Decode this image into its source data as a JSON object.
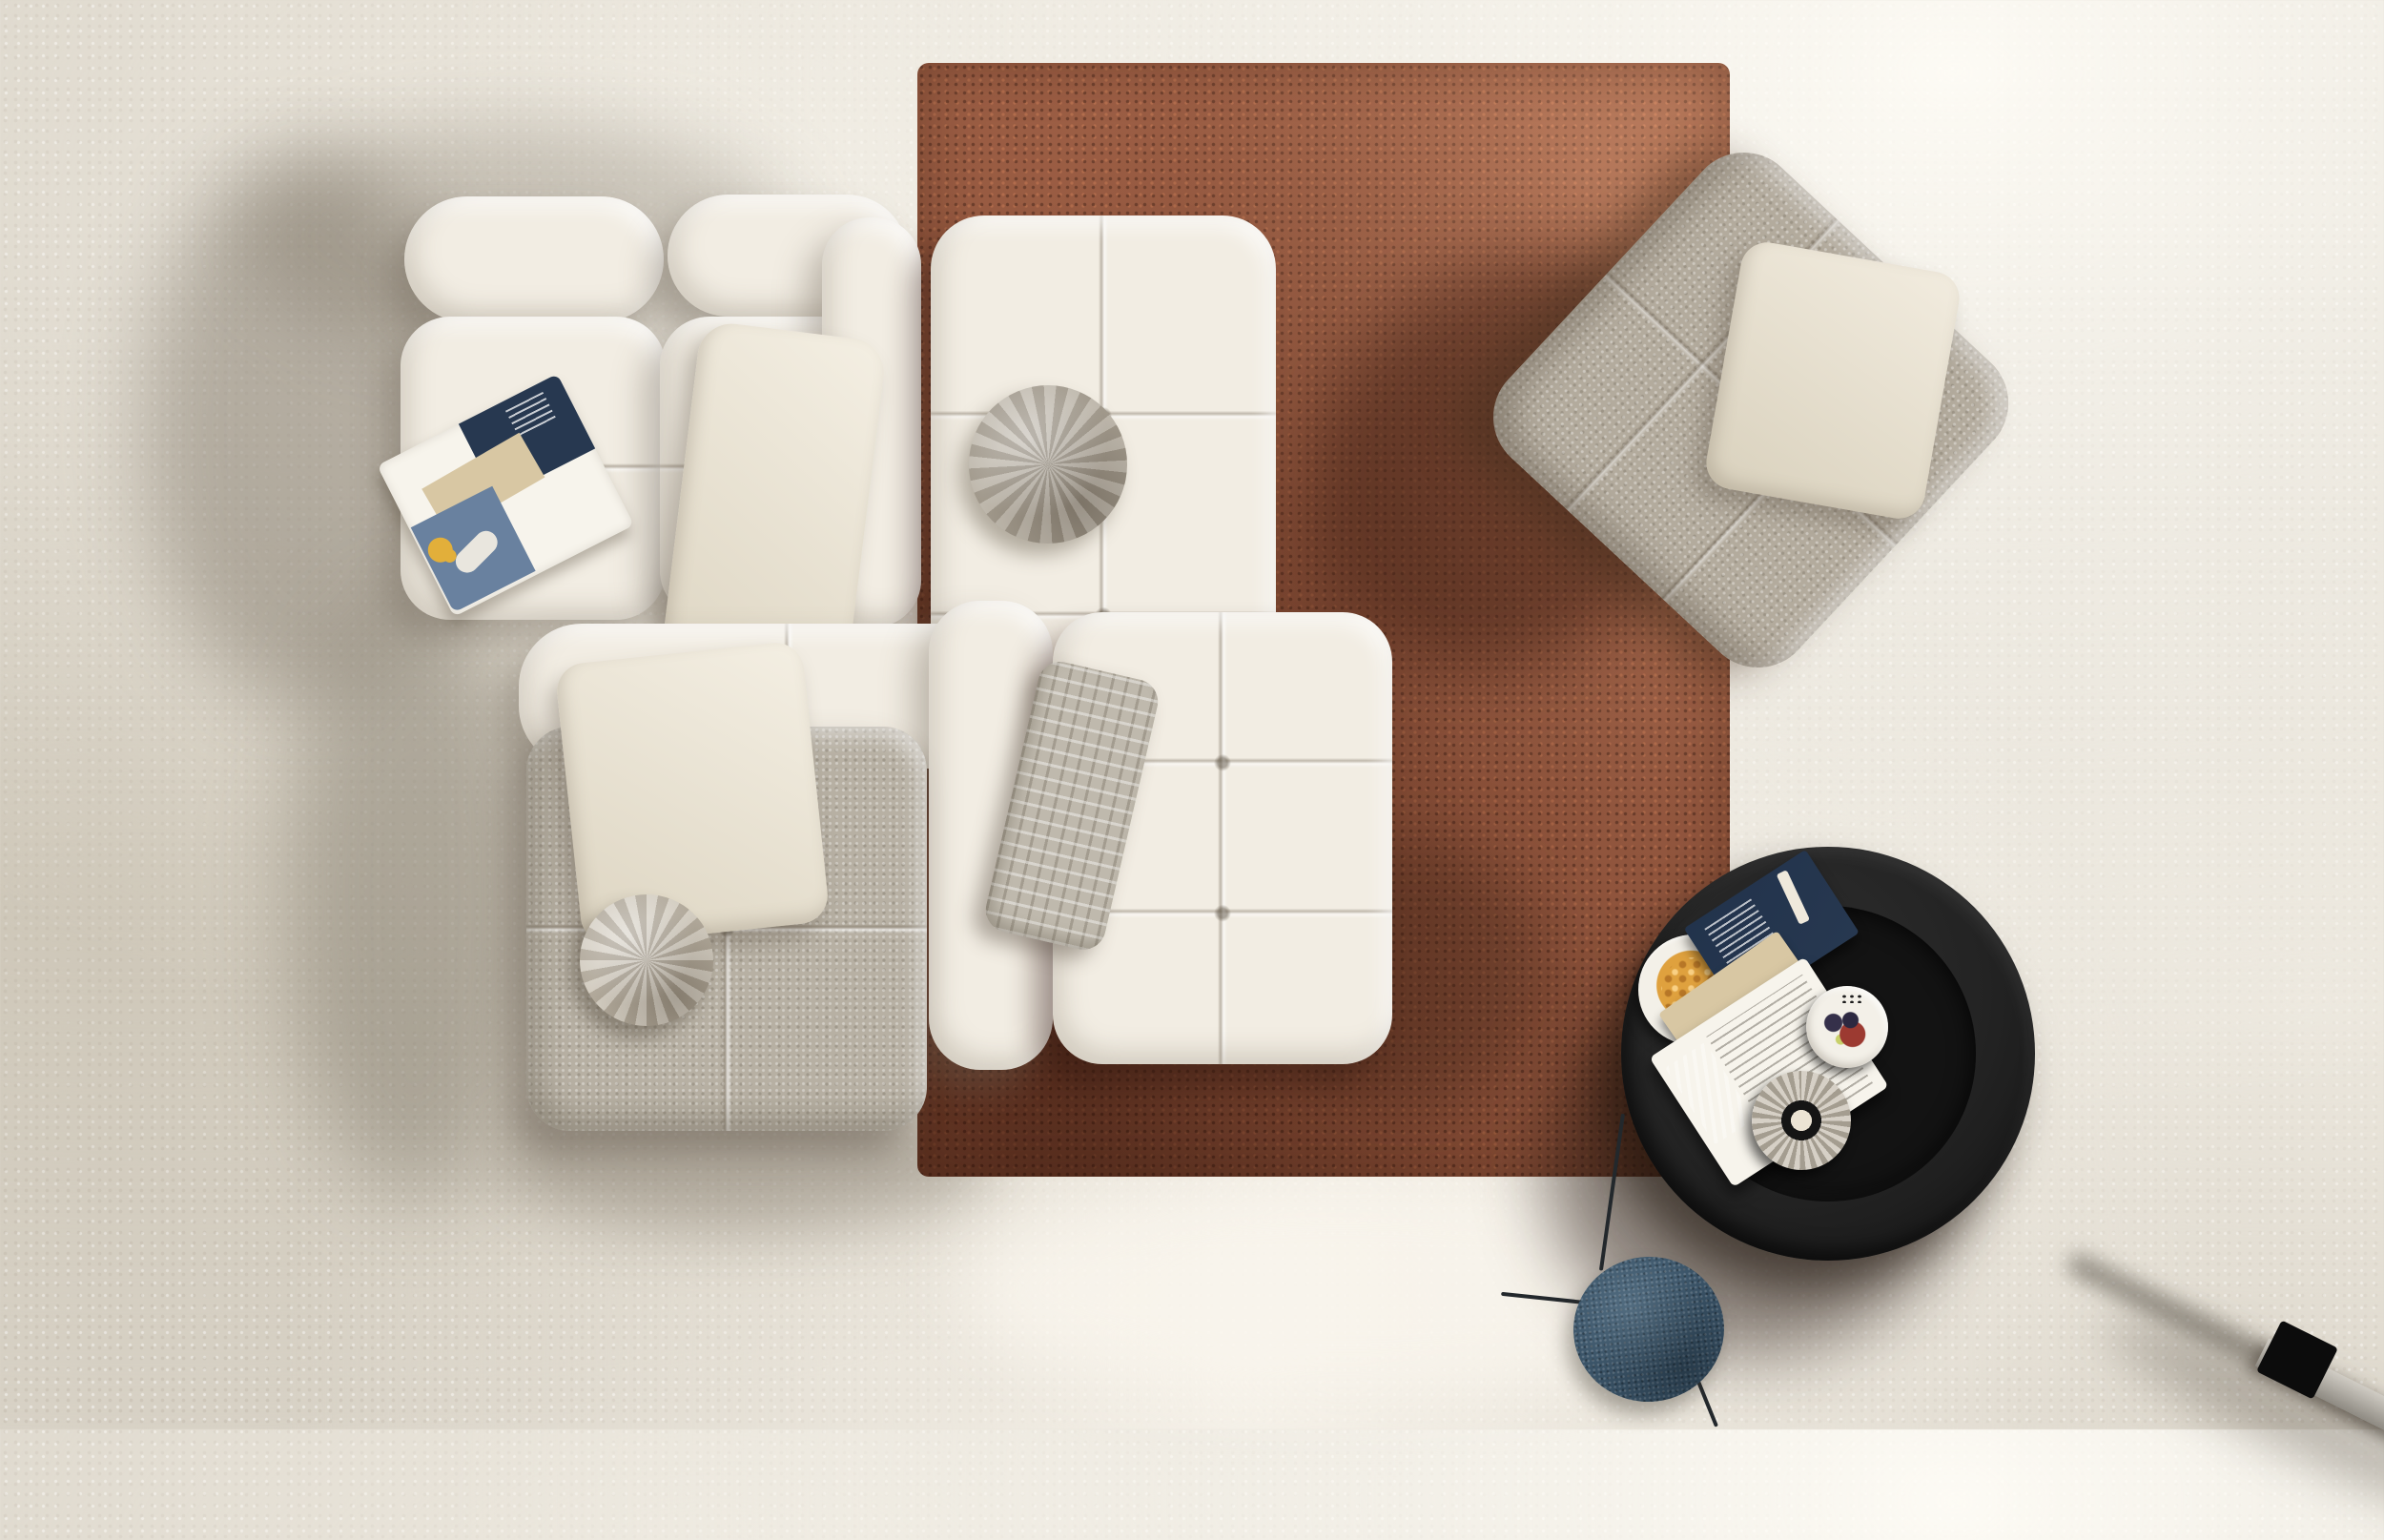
{
  "scene": {
    "type": "photograph-render",
    "description": "Top-down view of a living room: white modular tufted boucle sofa arranged around a rust terracotta shag rug on a pale concrete floor, with a grey tufted armchair, a black round coffee table holding snacks and a book, a small blue side table, and soft daylight shadows falling toward the lower left.",
    "lighting": "soft daylight from upper right",
    "colors": {
      "floor": "#d8d2c6",
      "floor_light": "#f6f2ea",
      "floor_shade": "#b9b1a0",
      "rug": "#9b5a41",
      "rug_dark": "#54291a",
      "rug_light": "#c08663",
      "sofa_white": "#f2ede3",
      "sofa_shade": "#cfc7b6",
      "sofa_gray": "#b7b0a3",
      "armchair_gray": "#b3ab9d",
      "pillow_cream": "#f4efe3",
      "pillow_round": "#b2aa9c",
      "pouf": "#c7bfb0",
      "woven": "#bfb9ad",
      "table_black": "#232323",
      "table_inner": "#131313",
      "plate_white": "#f3f0e8",
      "crackers": "#dfa13e",
      "berries": "#35304a",
      "tart": "#9c3a31",
      "book_navy": "#273850",
      "book_page": "#f7f4ec",
      "book_tan": "#d8c7a3",
      "mag_denim": "#69819f",
      "mag_yellow": "#e2af3a",
      "side_table_blue": "#3a5367",
      "leg_dark": "#23282c",
      "pole_gray": "#b3afa7",
      "pole_tip": "#0c0c0c",
      "shadow_warm": "#6f6755"
    }
  },
  "objects": {
    "floor": {
      "label": "Concrete floor"
    },
    "rug": {
      "label": "Rust terracotta shag rug"
    },
    "shadow": {
      "label": "Soft cast shadow"
    },
    "sofa": {
      "label": "White modular tufted boucle sofa",
      "bolster_left": {
        "label": "Back bolster cushion"
      },
      "bolster_right": {
        "label": "Back bolster cushion"
      },
      "seat_left": {
        "label": "Seat module with magazine"
      },
      "seat_right": {
        "label": "Seat module"
      },
      "armrest_left": {
        "label": "Armrest module"
      },
      "center_module": {
        "label": "Corner module on rug"
      },
      "mid_backrest": {
        "label": "Backrest module"
      },
      "mid_armrest": {
        "label": "Armrest module"
      },
      "ottoman": {
        "label": "Tufted ottoman module on rug"
      },
      "gray_module": {
        "label": "Grey suede sofa module"
      }
    },
    "round_pillow": {
      "label": "Round grey velvet pillow"
    },
    "cream_pillow": {
      "label": "Large cream lounge pillow"
    },
    "white_pillow": {
      "label": "White throw pillow"
    },
    "woven_pillow": {
      "label": "Grey basket-weave pillow"
    },
    "pouf": {
      "label": "Round pouf cushion"
    },
    "magazine": {
      "label": "Open fashion magazine"
    },
    "armchair": {
      "label": "Grey tufted armchair, rotated"
    },
    "armchair_pillow": {
      "label": "Cream cushion on armchair"
    },
    "coffee_table": {
      "label": "Black round coffee table"
    },
    "snack_bowl": {
      "label": "Bowl of crackers"
    },
    "open_book": {
      "label": "Open book with navy photo page"
    },
    "dessert_plate": {
      "label": "Plate with berries and tart"
    },
    "coaster": {
      "label": "Round wood-slice coaster with candle"
    },
    "side_table": {
      "label": "Blue round tripod side table"
    },
    "side_table_leg": {
      "label": "Side table leg"
    },
    "lamp_pole": {
      "label": "Metal pole with black tip"
    }
  }
}
